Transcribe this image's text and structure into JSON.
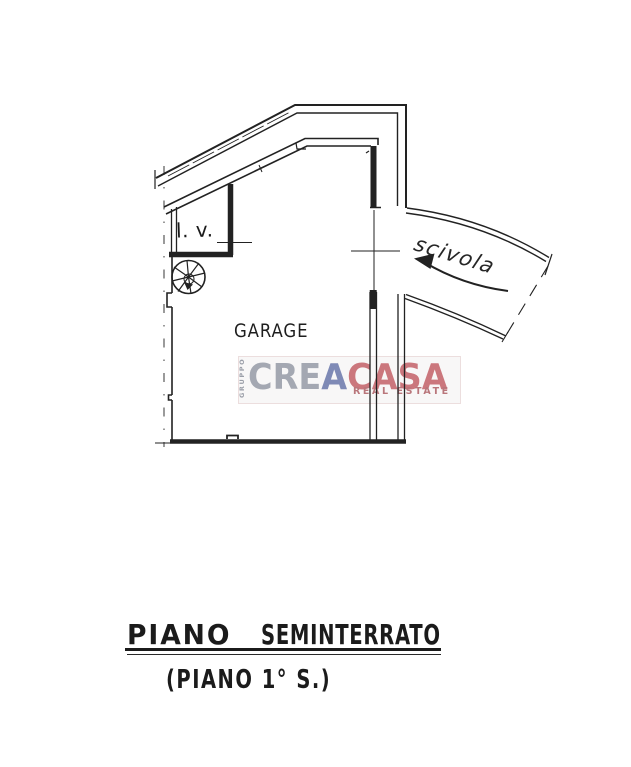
{
  "page": {
    "background": "#ffffff",
    "line_color": "#222222"
  },
  "floorplan": {
    "rooms": {
      "garage_label": "GARAGE",
      "lv_label": "l. v.",
      "ramp_label": "scivola"
    },
    "caption": {
      "line1_word1": "PIANO",
      "line1_word2": "SEMINTERRATO",
      "line2": "(PIANO 1° S.)"
    }
  },
  "watermark": {
    "vertical_label": "GRUPPO",
    "brand_gray": "CRE",
    "brand_blue": "A",
    "brand_red": "CASA",
    "tagline": "REAL ESTATE",
    "colors": {
      "brand_gray": "#a4a8b2",
      "brand_blue": "#7f8ab6",
      "brand_red": "#cb777d",
      "tagline": "#b9767b"
    }
  }
}
